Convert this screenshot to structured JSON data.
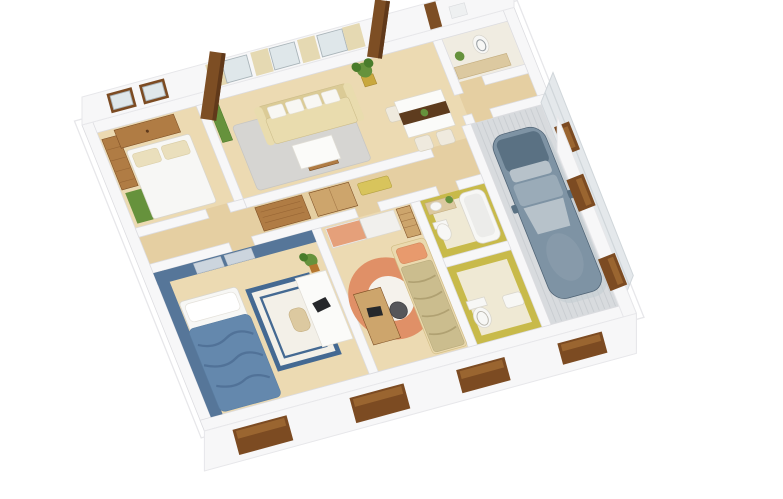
{
  "scene": {
    "description": "Photorealistic 3D isometric cutaway floor plan render of a single-story house, viewed from above at an angle, on a plain white background. White cut-top walls, light wood floors, fully furnished rooms and an attached garage with a parked car.",
    "rooms": [
      {
        "name": "bedroom-1",
        "position": "back-left",
        "features": [
          "double-bed-white-duvet",
          "beige-pillows",
          "wood-dresser",
          "wood-wardrobe",
          "green-rug",
          "two-brown-framed-windows"
        ]
      },
      {
        "name": "living-room",
        "position": "back-center",
        "features": [
          "beige-sofa",
          "white-cushions",
          "coffee-table-white-top",
          "gray-rug",
          "curtained-window-wall",
          "potted-plant",
          "green-cabinet"
        ]
      },
      {
        "name": "dining-area",
        "position": "back-center-right",
        "features": [
          "white-dining-table",
          "dark-brown-runner",
          "white-chairs",
          "small-plant"
        ]
      },
      {
        "name": "laundry-wc",
        "position": "back-right-corner",
        "features": [
          "toilet",
          "beige-counter",
          "potted-plant",
          "small-windows"
        ]
      },
      {
        "name": "entry-hall",
        "position": "right",
        "features": [
          "wood-floor"
        ]
      },
      {
        "name": "garage",
        "position": "right",
        "features": [
          "ribbed-concrete-floor",
          "gray-plank-walls",
          "brown-window",
          "parked-car"
        ]
      },
      {
        "name": "hallway",
        "position": "center",
        "features": [
          "wood-slat-cabinets",
          "yellow-bench"
        ]
      },
      {
        "name": "bathroom",
        "position": "center-right",
        "features": [
          "yellow-walls",
          "bathtub",
          "washbasin-wood-counter",
          "toilet",
          "small-plant"
        ]
      },
      {
        "name": "wc",
        "position": "front-center-right",
        "features": [
          "yellow-walls",
          "toilet",
          "washbasin"
        ]
      },
      {
        "name": "bedroom-2",
        "position": "front-left",
        "features": [
          "blue-accent-walls",
          "bed-blue-blanket",
          "white-rug-blue-border",
          "white-desk",
          "laptop",
          "tan-chair",
          "potted-plant"
        ]
      },
      {
        "name": "kids-room",
        "position": "front-center",
        "features": [
          "round-orange-rug",
          "bed-tan-blanket",
          "orange-pillow",
          "wood-desk",
          "dark-chair",
          "sliding-wardrobe-orange-white",
          "wood-shelf"
        ]
      }
    ],
    "exterior": [
      "two-wooden-roof-posts",
      "white-facade",
      "recessed-dark-wood-windows",
      "plank-garage-side-wall"
    ],
    "camera": "high angle, house rotated counter-clockwise ~15 degrees"
  },
  "colors": {
    "background": "#ffffff",
    "wall": "#f7f7f8",
    "wallEdge": "#dcdce0",
    "slabEdge": "#e7e7ea",
    "woodFloor": "#ecdab2",
    "woodFloor2": "#e5cfa2",
    "paleFloor": "#f0ece1",
    "woodMid": "#b07c44",
    "woodDark": "#7d4e24",
    "postShade": "#60391a",
    "woodSlat": "#cda56c",
    "green": "#66923c",
    "greenDark": "#497c2b",
    "potBrown": "#b5762e",
    "potYellow": "#c9a83e",
    "rugGray": "#d6d5d2",
    "sofa": "#e9dcae",
    "sofaDark": "#dbcb96",
    "cushion": "#f8f7f3",
    "whiteTop": "#fbfbf9",
    "runner": "#5e3c1e",
    "rugWhite": "#f3f0e8",
    "blueWall": "#567699",
    "blueBlanket": "#6488ad",
    "blueFold": "#4e6f94",
    "blueBorder": "#446992",
    "closetDoor": "#ccd5de",
    "kidsRug": "#e09067",
    "kidsRugCenter": "#f5f2ec",
    "kidsBlanket": "#cbbd8e",
    "kidsFold": "#b0a172",
    "kidsPillow": "#e89a6d",
    "kidsDoor": "#e5a07a",
    "kidsBedFrame": "#ead9ae",
    "tan": "#dcc9a0",
    "yellowWall": "#c8ba4a",
    "yellowFloor": "#efe9d4",
    "fixture": "#f7f7f5",
    "fixtureEdge": "#d9d6cd",
    "garageFloor": "#d8dbde",
    "garageRib": "#c9cdd1",
    "plank": "#e4e8eb",
    "plankLine": "#d0d6da",
    "carBody": "#7e93a4",
    "carDark": "#5a7183",
    "carGlass": "#b7c2ca",
    "carLight": "#9aabb8",
    "carShadow": "#c3ccd2",
    "winBrown": "#7c4b22",
    "winBrown2": "#9a6530",
    "laptop": "#26282b",
    "darkChair": "#55565a",
    "benchYellow": "#d8c45c",
    "curtain": "#e5d9b2",
    "winGlass": "#dfe7ea",
    "winFrame": "#a9b4b9"
  }
}
